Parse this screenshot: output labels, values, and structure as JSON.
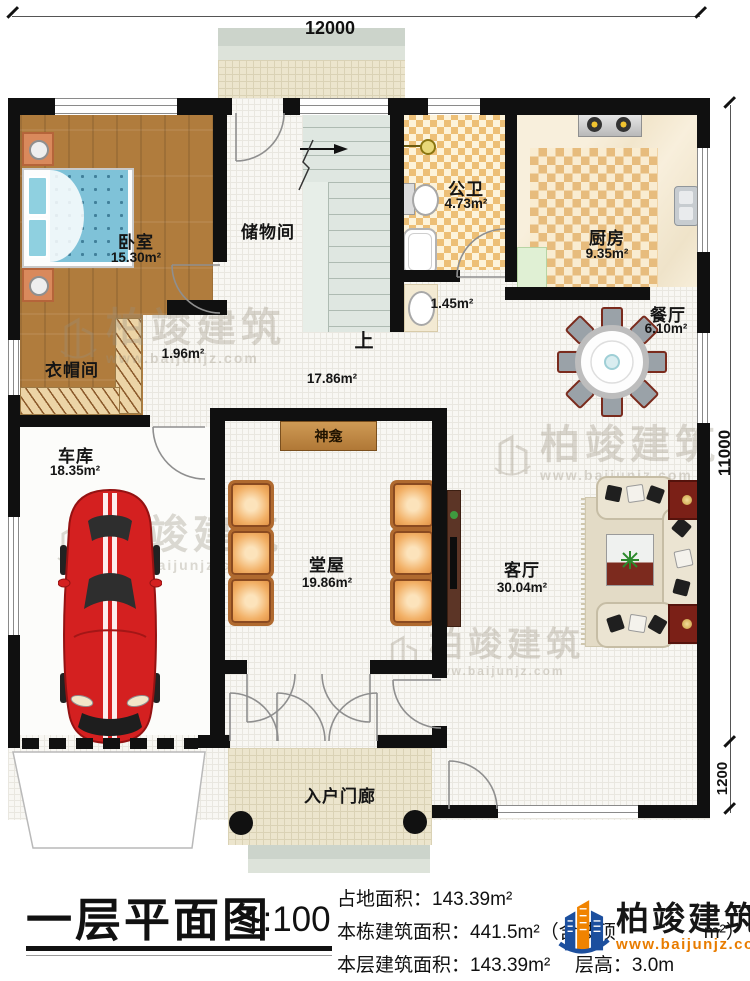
{
  "dimensions": {
    "top": "12000",
    "right": "11000",
    "right_lower": "1200"
  },
  "rooms": {
    "bedroom": {
      "name": "卧室",
      "area": "15.30m²"
    },
    "storage": {
      "name": "储物间"
    },
    "stairs": {
      "up": "上"
    },
    "hallway": {
      "area": "17.86m²"
    },
    "passage": {
      "area": "1.96m²"
    },
    "bath": {
      "name": "公卫",
      "area": "4.73m²"
    },
    "wash": {
      "area": "1.45m²"
    },
    "kitchen": {
      "name": "厨房",
      "area": "9.35m²"
    },
    "dining": {
      "name": "餐厅",
      "area": "6.10m²"
    },
    "cloak": {
      "name": "衣帽间"
    },
    "garage": {
      "name": "车库",
      "area": "18.35m²"
    },
    "shrine": {
      "name": "神龛"
    },
    "hall": {
      "name": "堂屋",
      "area": "19.86m²"
    },
    "living": {
      "name": "客厅",
      "area": "30.04m²"
    },
    "porch": {
      "name": "入户门廊"
    }
  },
  "title_block": {
    "title": "一层平面图",
    "scale": "1:100",
    "site_area": "占地面积：143.39m²",
    "building_area": "本栋建筑面积：441.5m²（含坡顶",
    "building_area_suffix": "m²）",
    "floor_area": "本层建筑面积：143.39m²",
    "floor_height": "层高：3.0m"
  },
  "watermark": {
    "brand": "柏竣建筑",
    "url": "www.baijunjz.com"
  },
  "logo": {
    "brand": "柏竣建筑",
    "url": "www.baijunjz.com"
  },
  "colors": {
    "wall": "#101010",
    "wood": "#b07c3d",
    "accent_orange": "#e87c00",
    "logo_blue": "#1c4f9e",
    "car_red": "#d42020"
  }
}
